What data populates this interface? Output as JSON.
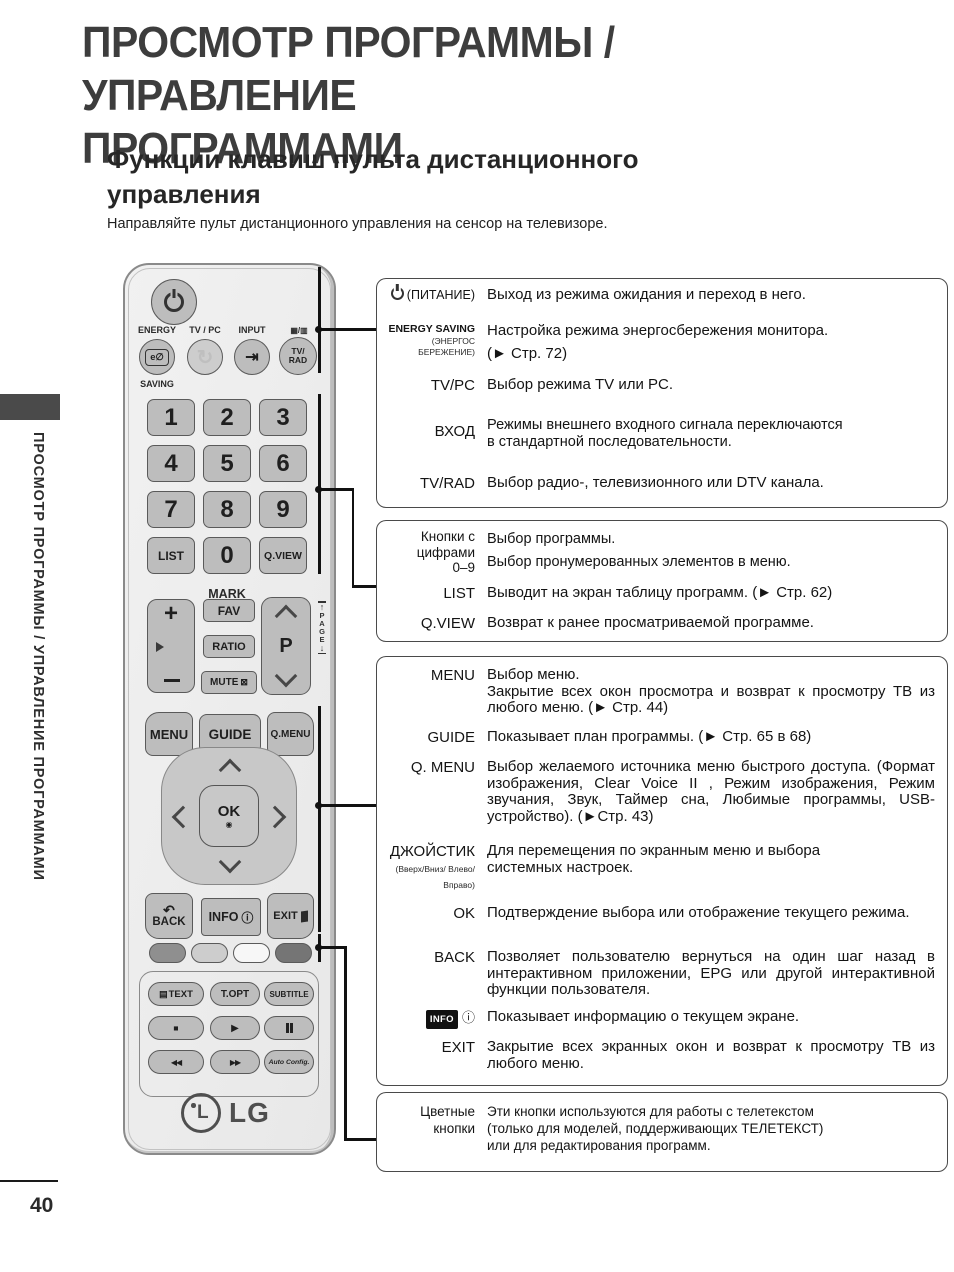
{
  "page": {
    "title_line1": "ПРОСМОТР ПРОГРАММЫ / УПРАВЛЕНИЕ",
    "title_line2": "ПРОГРАММАМИ",
    "heading_line1": "Функции клавиш пульта дистанционного",
    "heading_line2": "управления",
    "intro": "Направляйте пульт дистанционного управления на сенсор на телевизоре.",
    "sidebar_text": "ПРОСМОТР ПРОГРАММЫ / УПРАВЛЕНИЕ ПРОГРАММАМИ",
    "page_number": "40"
  },
  "remote": {
    "energy_label_top": "ENERGY",
    "energy_label_bottom": "SAVING",
    "energy_icon": "e∅",
    "tvpc_label": "TV / PC",
    "tvpc_icon": "↻",
    "input_label": "INPUT",
    "input_icon": "⇥",
    "tvrad_icon": "▦/▥",
    "tvrad_line1": "TV/",
    "tvrad_line2": "RAD",
    "digits": [
      "1",
      "2",
      "3",
      "4",
      "5",
      "6",
      "7",
      "8",
      "9"
    ],
    "zero": "0",
    "list_label": "LIST",
    "qview_label": "Q.VIEW",
    "mark_label": "MARK",
    "fav_label": "FAV",
    "ratio_label": "RATIO",
    "mute_label": "MUTE",
    "mute_icon": "⊠",
    "plus": "+",
    "p_label": "P",
    "page_label": "PAGE",
    "page_up": "↑",
    "page_down": "↓",
    "menu_label": "MENU",
    "guide_label": "GUIDE",
    "qmenu_label": "Q.MENU",
    "ok_label": "OK",
    "ok_dot": "◉",
    "back_icon": "↶",
    "back_label": "BACK",
    "info_label": "INFO",
    "info_icon": "ⓘ",
    "exit_label": "EXIT",
    "text_icon": "▤",
    "text_label": "TEXT",
    "topt_label": "T.OPT",
    "subtitle_label": "SUBTITLE",
    "stop_icon": "■",
    "play_icon": "▶",
    "rew_icon": "◀◀",
    "ff_icon": "▶▶",
    "autoconfig_label": "Auto Config.",
    "lg_monogram": "L",
    "lg_word": "LG"
  },
  "callouts": {
    "box1": {
      "rows": [
        {
          "label": "(ПИТАНИЕ)",
          "desc": "Выход из режима ожидания и переход в него."
        },
        {
          "label": "ENERGY SAVING",
          "sublabel": "(ЭНЕРГОС БЕРЕЖЕНИЕ)",
          "desc_lines": [
            "Настройка режима энергосбережения монитора.",
            "(► Стр. 72)"
          ]
        },
        {
          "label": "TV/PC",
          "desc": "Выбор режима TV или PC."
        },
        {
          "label": "ВХОД",
          "desc_lines": [
            "Режимы внешнего входного сигнала переключаются",
            "в стандартной последовательности."
          ]
        },
        {
          "label": "TV/RAD",
          "desc": "Выбор радио-, телевизионного или DTV канала."
        }
      ]
    },
    "box2": {
      "rows": [
        {
          "label_lines": [
            "Кнопки с",
            "цифрами",
            "0–9"
          ],
          "desc_lines": [
            "Выбор программы.",
            "Выбор пронумерованных элементов в меню."
          ]
        },
        {
          "label": "LIST",
          "desc": "Выводит на экран таблицу программ. (► Стр. 62)"
        },
        {
          "label": "Q.VIEW",
          "desc": "Возврат к ранее просматриваемой программе."
        }
      ]
    },
    "box3": {
      "rows": [
        {
          "label": "MENU",
          "desc_line1": "Выбор меню.",
          "desc_just": "Закрытие всех окон просмотра и возврат к просмотру ТВ из любого меню. (► Стр. 44)"
        },
        {
          "label": "GUIDE",
          "desc": "Показывает план программы. (► Стр. 65 в 68)"
        },
        {
          "label": "Q. MENU",
          "desc_just": "Выбор желаемого источника меню быстрого доступа. (Формат изображения, Clear Voice II , Режим изображения, Режим звучания, Звук, Таймер сна, Любимые программы, USB-устройство). (►Стр. 43)"
        },
        {
          "label": "ДЖОЙСТИК",
          "sublabel_lines": [
            "(Вверх/Вниз/ Влево/",
            "Вправо)"
          ],
          "desc_lines": [
            "Для перемещения по экранным меню и выбора",
            "системных настроек."
          ]
        },
        {
          "label": "OK",
          "desc_just": "Подтверждение выбора или отображение текущего режима."
        },
        {
          "label": "BACK",
          "desc_just": "Позволяет пользователю вернуться на один шаг назад в интерактивном приложении, EPG или другой интерактивной функции пользователя."
        },
        {
          "label": "INFO",
          "label_icon": "ⓘ",
          "desc": "Показывает информацию о текущем экране."
        },
        {
          "label": "EXIT",
          "desc_just": "Закрытие всех экранных окон и возврат к просмотру ТВ из любого меню."
        }
      ]
    },
    "box4": {
      "rows": [
        {
          "label_lines": [
            "Цветные",
            "кнопки"
          ],
          "desc_lines": [
            "Эти кнопки используются для работы с телетекстом",
            "(только для моделей, поддерживающих ТЕЛЕТЕКСТ)",
            "или для редактирования программ."
          ]
        }
      ]
    }
  }
}
